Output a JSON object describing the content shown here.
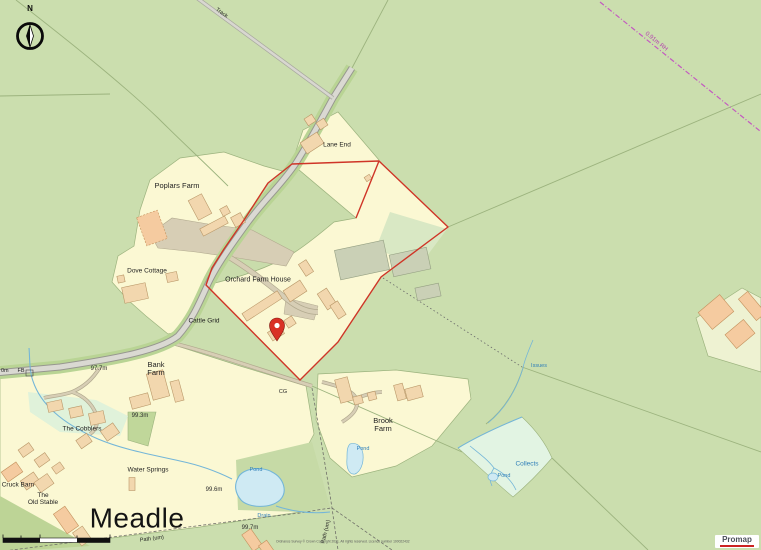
{
  "map": {
    "compass": {
      "north_label": "N"
    },
    "logo": {
      "text": "Promap"
    },
    "attribution": "Ordnance Survey © Crown Copyright 2021. All rights reserved. Licence number 100022432",
    "labels": {
      "track": "Track",
      "boundary_annotation": "0.91m RH",
      "lane_end": "Lane End",
      "poplars_farm": "Poplars Farm",
      "dove_cottage": "Dove Cottage",
      "orchard_farm_house": "Orchard Farm House",
      "cattle_grid": "Cattle Grid",
      "cg": "CG",
      "fb": "FB",
      "edge_partial_height": "0m",
      "bank_farm_line1": "Bank",
      "bank_farm_line2": "Farm",
      "brook_farm_line1": "Brook",
      "brook_farm_line2": "Farm",
      "the_cobblers": "The Cobblers",
      "water_springs": "Water Springs",
      "cruck_barn": "Cruck Barn",
      "old_stable_line1": "The",
      "old_stable_line2": "Old Stable",
      "meadle": "Meadle",
      "path_um_south": "Path (um)",
      "path_um_east": "Path (um)",
      "drain": "Drain",
      "issues": "Issues",
      "collects": "Collects",
      "pond_brook": "Pond",
      "pond_meadle": "Pond",
      "pond_collects": "Pond"
    },
    "spot_heights": {
      "h1": "97.7m",
      "h2": "99.3m",
      "h3": "99.6m",
      "h4": "99.7m"
    },
    "colors": {
      "field_green": "#cbdeae",
      "plot_cream": "#fbf8d3",
      "building_tan": "#f2d7ae",
      "road_grey": "#dad9d2",
      "red_boundary": "#cf3527",
      "pin_red": "#d93025",
      "water_blue": "#74b6d8",
      "water_label_blue": "#2f7fb8",
      "admin_magenta": "#c35ac0",
      "marsh_mint": "#e2f4e3"
    }
  }
}
